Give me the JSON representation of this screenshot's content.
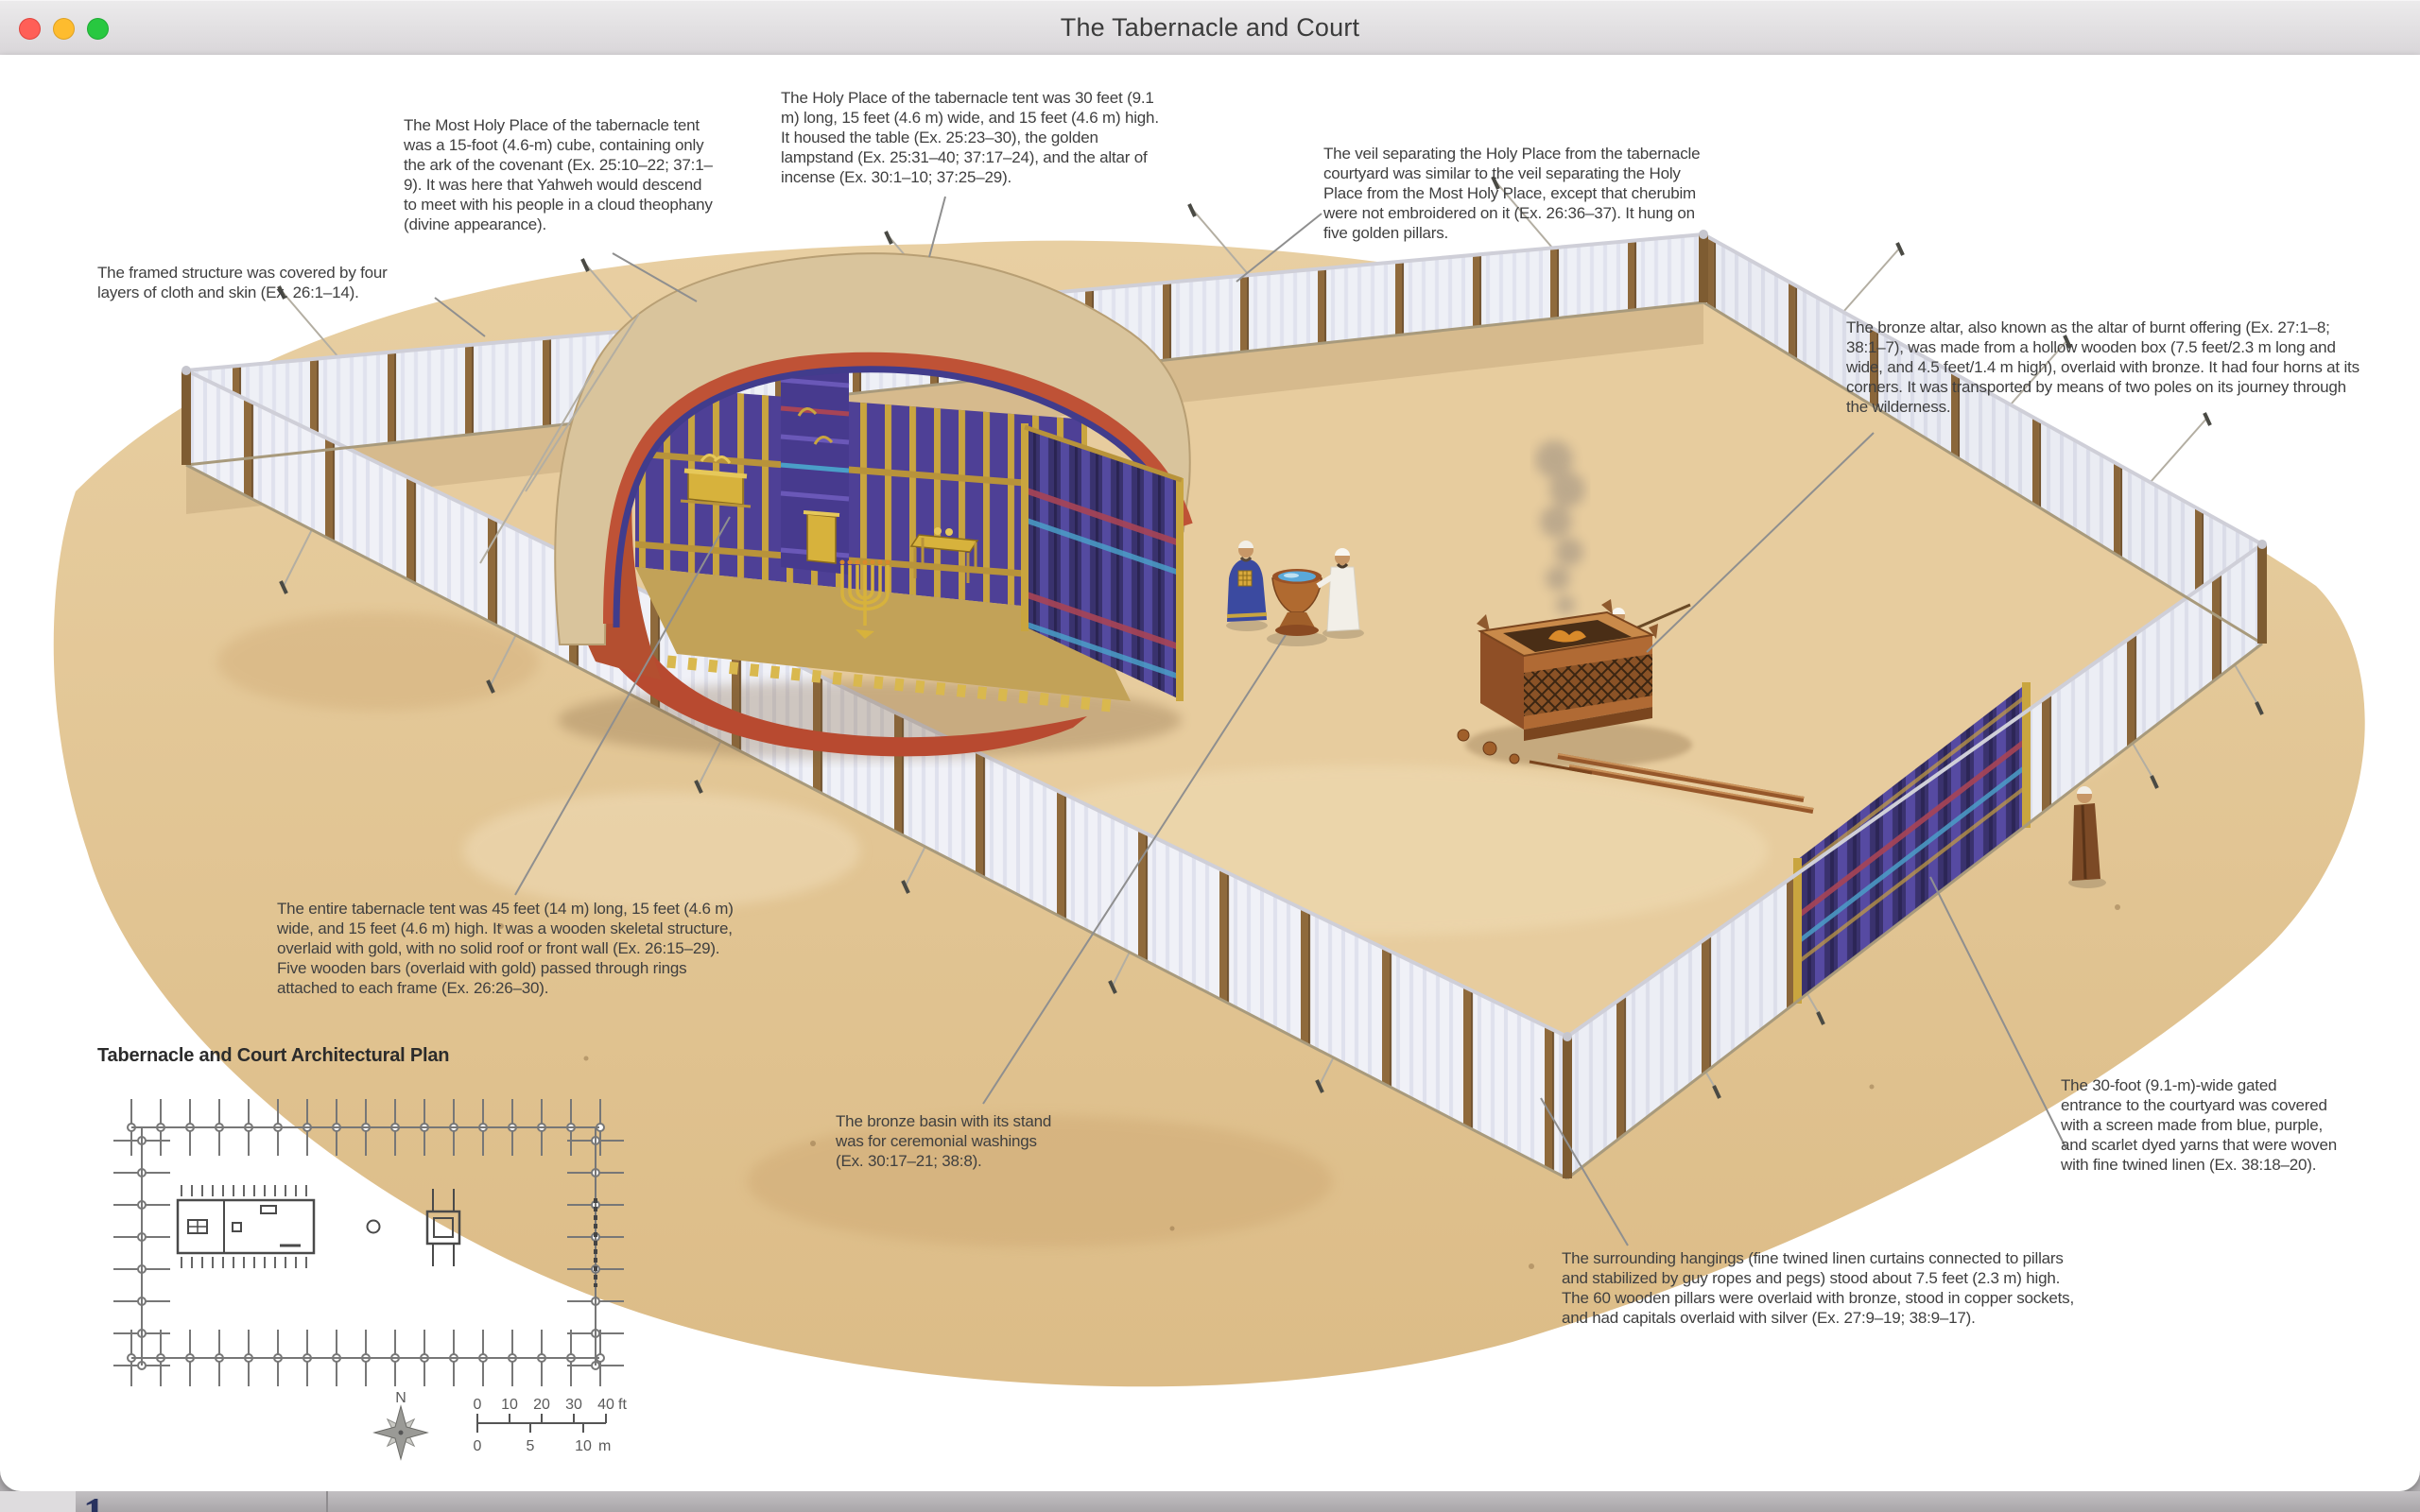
{
  "window": {
    "title": "The Tabernacle and Court",
    "traffic_lights": [
      "close",
      "minimize",
      "zoom"
    ]
  },
  "figure": {
    "annotations": [
      {
        "id": "most-holy-place",
        "text": "The Most Holy Place of the tabernacle tent was a 15-foot (4.6-m) cube, containing only the ark of the covenant (Ex. 25:10–22; 37:1–9). It was here that Yahweh would descend to meet with his people in a cloud theophany (divine appearance)."
      },
      {
        "id": "holy-place",
        "text": "The Holy Place of the tabernacle tent was 30 feet (9.1 m) long, 15 feet (4.6 m) wide, and 15 feet (4.6 m) high. It housed the table (Ex. 25:23–30), the golden lampstand (Ex. 25:31–40; 37:17–24), and the altar of incense (Ex. 30:1–10; 37:25–29)."
      },
      {
        "id": "veil",
        "text": "The veil separating the Holy Place from the tabernacle courtyard was similar to the veil separating the Holy Place from the Most Holy Place, except that cherubim were not embroidered on it (Ex. 26:36–37). It hung on five golden pillars."
      },
      {
        "id": "framed-structure",
        "text": "The framed structure was covered by four layers of cloth and skin (Ex. 26:1–14)."
      },
      {
        "id": "bronze-altar",
        "text": "The bronze altar, also known as the altar of burnt offering (Ex. 27:1–8; 38:1–7), was made from a hollow wooden box (7.5 feet/2.3 m long and wide, and 4.5 feet/1.4 m high), overlaid with bronze. It had four horns at its corners. It was transported by means of two poles on its journey through the wilderness."
      },
      {
        "id": "entire-tent",
        "text": "The entire tabernacle tent was 45 feet (14 m) long, 15 feet (4.6 m) wide, and 15 feet (4.6 m) high. It was a wooden skeletal structure, overlaid with gold, with no solid roof or front wall (Ex. 26:15–29). Five wooden bars (overlaid with gold) passed through rings attached to each frame (Ex. 26:26–30)."
      },
      {
        "id": "bronze-basin",
        "text": "The bronze basin with its stand was for ceremonial washings (Ex. 30:17–21; 38:8)."
      },
      {
        "id": "gated-entrance",
        "text": "The 30-foot (9.1-m)-wide gated entrance to the courtyard was covered with a screen made from blue, purple, and scarlet dyed yarns that were woven with fine twined linen (Ex. 38:18–20)."
      },
      {
        "id": "surrounding-hangings",
        "text": "The surrounding hangings (fine twined linen curtains connected to pillars and stabilized by guy ropes and pegs) stood about 7.5 feet (2.3 m) high. The 60 wooden pillars were overlaid with bronze, stood in copper sockets, and had capitals overlaid with silver (Ex. 27:9–19; 38:9–17)."
      }
    ],
    "plan": {
      "heading": "Tabernacle and Court Architectural Plan",
      "compass_label": "N",
      "scale_ft": {
        "labels": [
          "0",
          "10",
          "20",
          "30",
          "40"
        ],
        "unit": "ft"
      },
      "scale_m": {
        "labels": [
          "0",
          "5",
          "10"
        ],
        "unit": "m"
      }
    }
  },
  "page": {
    "page_number": "1",
    "body_segments": [
      {
        "text": "17–19)",
        "emphasis": "reference"
      },
      {
        "text": "—lesser metals than the pure gold prescribed for the elements inside the tabernacle ",
        "emphasis": "normal"
      },
      {
        "text": "(25:10–40)",
        "emphasis": "reference"
      },
      {
        "text": ", since",
        "emphasis": "normal"
      }
    ]
  },
  "colors": {
    "titlebar_text": "#3b3b3b",
    "traffic_close": "#ff5f57",
    "traffic_minimize": "#febc2e",
    "traffic_zoom": "#28c840",
    "annotation_text": "#3f3f3f",
    "leader_line": "#8f8f8f",
    "sand": "#e2c493",
    "linen": "#eef0f6",
    "wood_post": "#8f6a3c",
    "gold": "#c9a53f",
    "indigo": "#4a3c90",
    "scarlet": "#b84a30",
    "copper": "#b06a30",
    "plan_line": "#555555",
    "page_reference": "#28325f",
    "page_body": "#3a2f28",
    "page_background": "#b2afb2"
  }
}
